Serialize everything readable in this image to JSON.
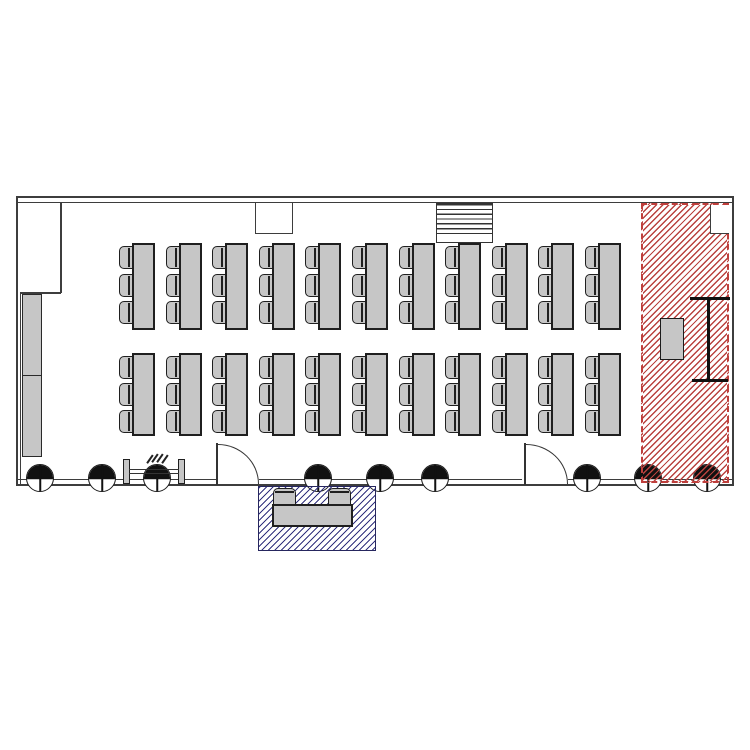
{
  "canvas": {
    "width": 750,
    "height": 750,
    "background": "#ffffff"
  },
  "colors": {
    "wall": "#3d3d3d",
    "furniture_fill": "#c6c6c6",
    "furniture_outline": "#1f1f1f",
    "red_zone_hatch": "#b9423f",
    "red_zone_border": "#bf3f3c",
    "blue_zone_hatch": "#32327e",
    "column_fill": "#111111"
  },
  "summary": {
    "table_rows": 2,
    "tables_per_row": 11,
    "chairs_per_table": 3,
    "structural_columns": 9,
    "doors": 2,
    "highlighted_zones": 2
  },
  "floor_plan": {
    "walls": [
      [
        16,
        196,
        718,
        2
      ],
      [
        16,
        202,
        717,
        1
      ],
      [
        16,
        196,
        2,
        290
      ],
      [
        20,
        292,
        1,
        192
      ],
      [
        60,
        202,
        2,
        91
      ],
      [
        20,
        292,
        41,
        2
      ],
      [
        732,
        196,
        2,
        290
      ],
      [
        16,
        484,
        718,
        2
      ],
      [
        16,
        479,
        201,
        1.3
      ],
      [
        259,
        479,
        263,
        1.3
      ],
      [
        568,
        479,
        165,
        1.3
      ]
    ],
    "furniture": {
      "table_w": 23,
      "chair_w": 14,
      "chair_h": 23,
      "table_columns_x": [
        132,
        179,
        225,
        272,
        318,
        365,
        412,
        458,
        505,
        551,
        598
      ],
      "rows": [
        {
          "table_y": 243,
          "table_h": 87,
          "chair_ys": [
            246,
            274,
            301
          ]
        },
        {
          "table_y": 353,
          "table_h": 83,
          "chair_ys": [
            356,
            383,
            410
          ]
        }
      ]
    },
    "structural_columns": {
      "centers_x": [
        40,
        102,
        157,
        318,
        380,
        435,
        587,
        648,
        707
      ],
      "center_y": 478,
      "diameter": 28
    },
    "zones": {
      "red": {
        "rect": [
          641,
          203,
          88,
          280
        ],
        "notch_rel": [
          67,
          0,
          19,
          29
        ],
        "podium_rel": [
          17,
          113,
          24,
          42
        ],
        "lines_rel": [
          [
            47,
            92,
            40,
            2.5
          ],
          [
            64,
            92,
            2.5,
            84
          ],
          [
            49,
            174,
            36,
            2.5
          ]
        ]
      },
      "blue": {
        "rect": [
          258,
          486,
          118,
          65
        ],
        "bench_rel": [
          13,
          17,
          81,
          23
        ],
        "chairs_rel": [
          [
            14,
            1,
            23,
            17
          ],
          [
            69,
            1,
            23,
            17
          ]
        ]
      }
    },
    "doors": [
      {
        "leaf": [
          216,
          443,
          2,
          42
        ],
        "arc": [
          218,
          444,
          41,
          40
        ]
      },
      {
        "leaf": [
          524,
          443,
          2,
          42
        ],
        "arc": [
          526,
          444,
          42,
          40
        ]
      }
    ],
    "stairs": {
      "rect": [
        436,
        203,
        57,
        40
      ],
      "stripe_h": 33
    },
    "wall_recess": [
      255,
      203,
      38,
      31
    ],
    "wall_cabinets": [
      [
        22,
        294,
        20,
        83
      ],
      [
        22,
        375,
        20,
        82
      ]
    ],
    "entry_rail": {
      "posts": [
        [
          123,
          459,
          7,
          25
        ],
        [
          178,
          459,
          7,
          25
        ]
      ],
      "rails": [
        [
          129,
          469,
          50,
          1.3
        ],
        [
          129,
          473,
          50,
          1.3
        ]
      ],
      "ticks": [
        [
          149,
          454,
          1.5,
          10
        ],
        [
          154,
          453,
          1.5,
          10
        ],
        [
          159,
          453,
          1.5,
          10
        ],
        [
          164,
          454,
          1.5,
          10
        ]
      ]
    }
  }
}
